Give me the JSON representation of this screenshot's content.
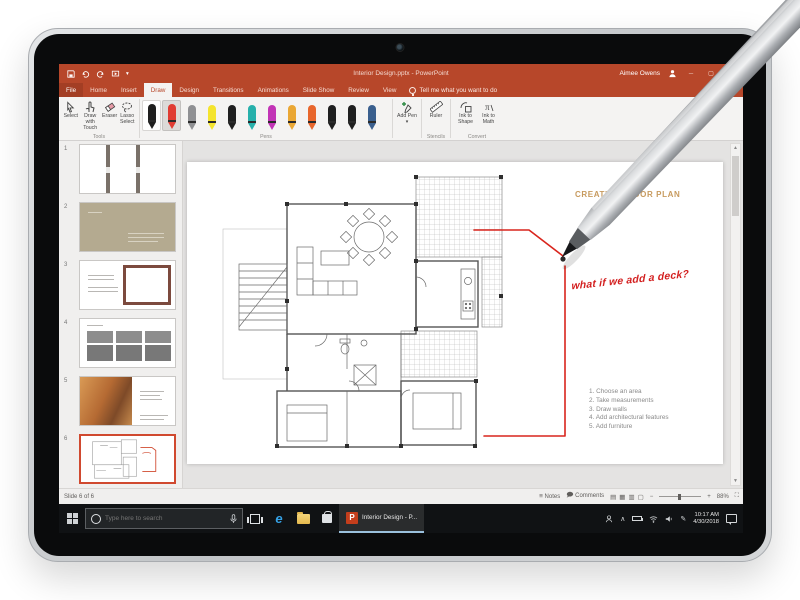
{
  "titlebar": {
    "document_title": "Interior Design.pptx - PowerPoint",
    "user_name": "Aimee Owens",
    "controls": {
      "minimize": "─",
      "maximize": "▢",
      "close": "✕"
    }
  },
  "ribbon": {
    "tabs": [
      "File",
      "Home",
      "Insert",
      "Draw",
      "Design",
      "Transitions",
      "Animations",
      "Slide Show",
      "Review",
      "View"
    ],
    "active_tab": "Draw",
    "tell_me": "Tell me what you want to do",
    "groups": {
      "tools": {
        "label": "Tools",
        "buttons": [
          "Select",
          "Draw with Touch",
          "Eraser",
          "Lasso Select"
        ]
      },
      "pens": {
        "label": "Pens",
        "selected_index": 1,
        "colors": [
          "#1f1f1f",
          "#e03b32",
          "#8f9093",
          "#f4e42e",
          "#1f1f1f",
          "#27b0ab",
          "#c234b6",
          "#eaa734",
          "#e8662c",
          "#1f1f1f",
          "#1f1f1f",
          "#3a5f8e"
        ]
      },
      "add_pen": {
        "label": "Add Pen",
        "dropdown": "▾"
      },
      "stencils": {
        "label": "Stencils",
        "buttons": [
          "Ruler"
        ]
      },
      "convert": {
        "label": "Convert",
        "buttons": [
          "Ink to Shape",
          "Ink to Math"
        ]
      }
    }
  },
  "thumbnails": {
    "numbers": [
      "1",
      "2",
      "3",
      "4",
      "5",
      "6"
    ],
    "selected": "6"
  },
  "slide": {
    "title": "CREATE A FLOOR PLAN",
    "ink_note": "what if we add a deck?",
    "steps": [
      "1. Choose an area",
      "2. Take measurements",
      "3. Draw walls",
      "4. Add architectural features",
      "5. Add furniture"
    ]
  },
  "statusbar": {
    "slide_indicator": "Slide 6 of 6",
    "notes_label": "Notes",
    "comments_label": "Comments",
    "view_icons": [
      "▤",
      "▦",
      "▥",
      "▢"
    ],
    "zoom_minus": "−",
    "zoom_plus": "+",
    "zoom_level": "88%"
  },
  "taskbar": {
    "search_placeholder": "Type here to search",
    "active_task": "Interior Design - P...",
    "time": "10:17 AM",
    "date": "4/30/2018",
    "icons": {
      "edge": "e",
      "tray_chevron": "∧",
      "tray_pen": "✎"
    }
  },
  "colors": {
    "accent": "#b7472a",
    "ink_red": "#d9251d",
    "slide_title": "#c79a5e",
    "taskbar": "#101214"
  }
}
